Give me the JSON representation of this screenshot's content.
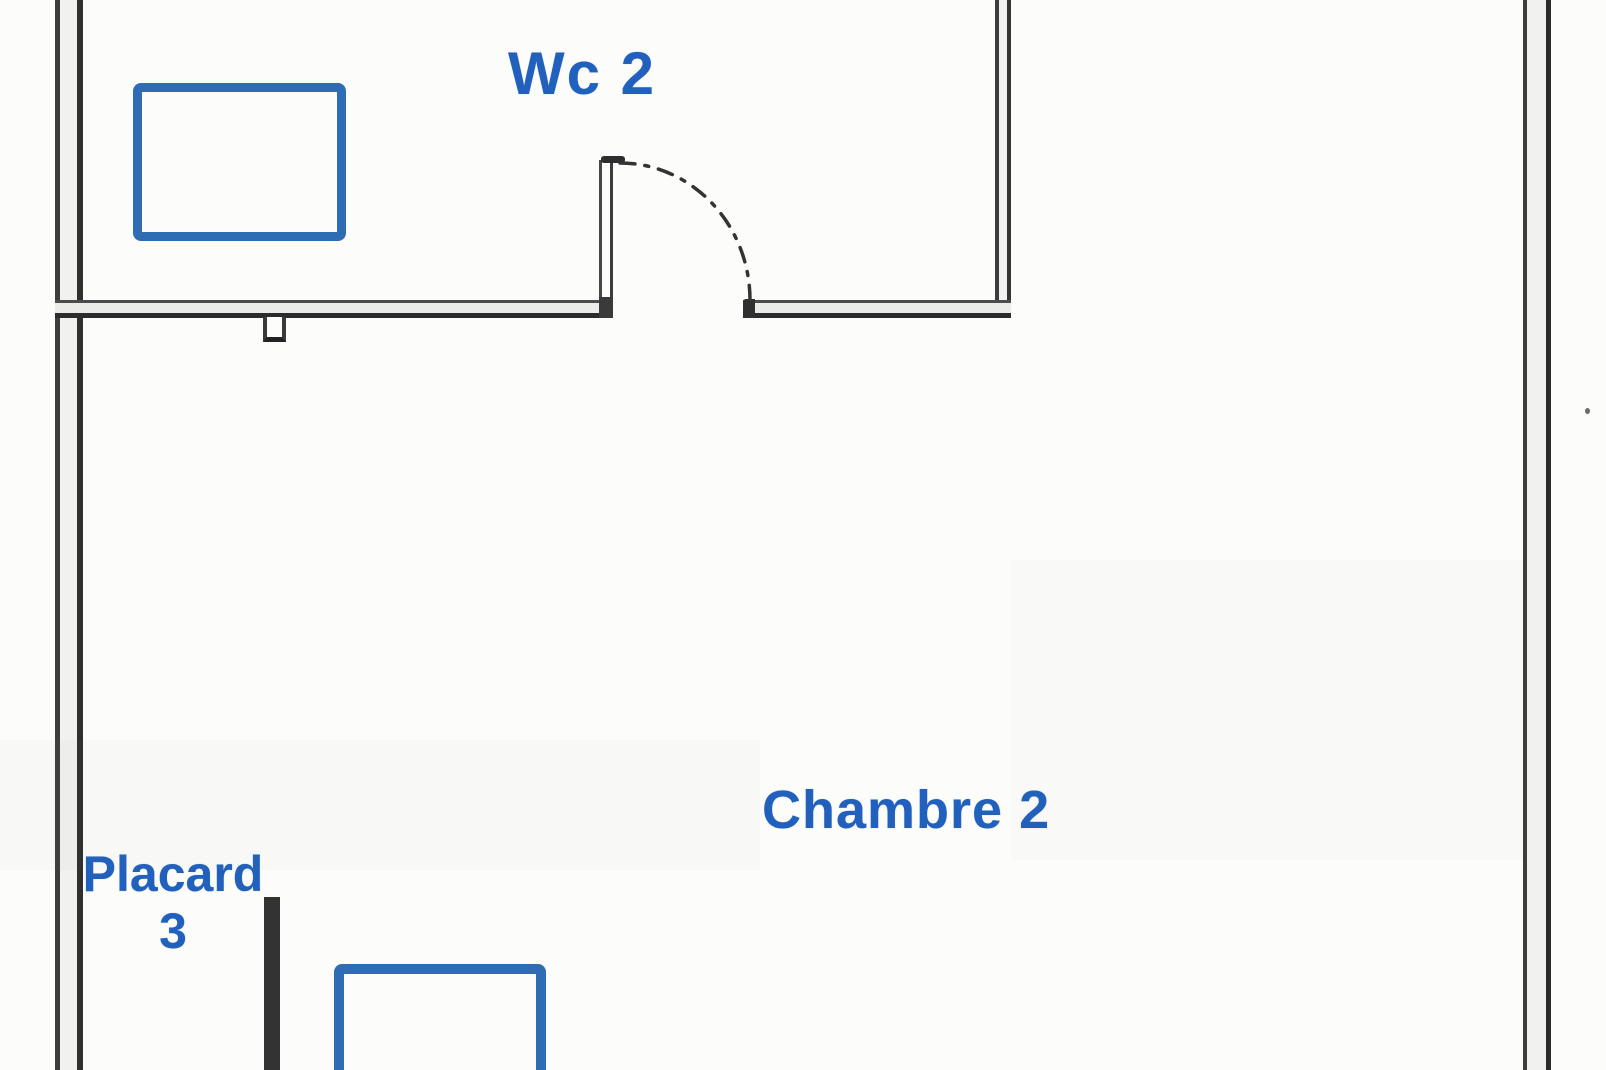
{
  "labels": {
    "wc": "Wc 2",
    "chambre": "Chambre 2",
    "placard": "Placard",
    "placard_number": "3"
  },
  "colors": {
    "label_blue": "#2161bd",
    "fixture_blue": "#2f6cb3",
    "wall_line_dark": "#3a3a3a",
    "wall_fill_light": "#efefed",
    "partition_black": "#333333",
    "background": "#fcfcfb"
  }
}
